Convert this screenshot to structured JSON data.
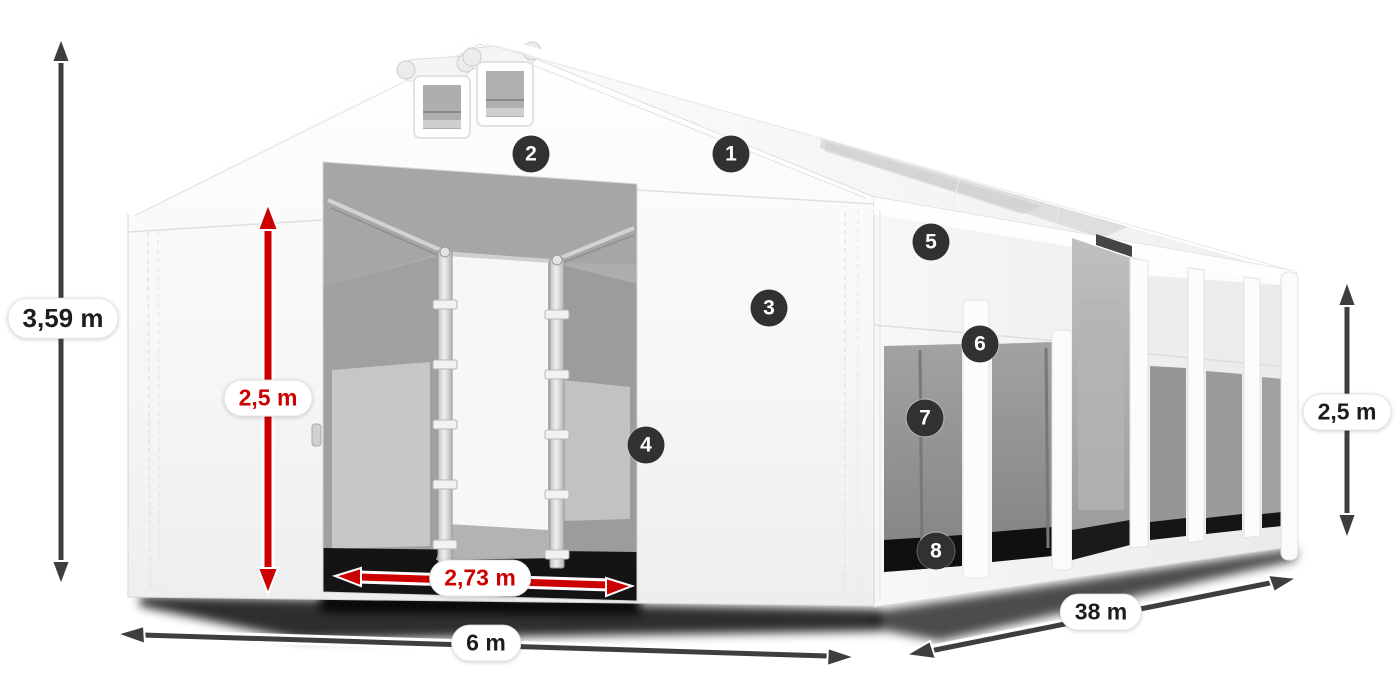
{
  "diagram": {
    "subject": "white storage tent 6 x 38 m, three-quarter view with open front doors and side windows"
  },
  "dimension_labels": {
    "total_height": "3,59 m",
    "inner_door_height": "2,5 m",
    "door_width": "2,73 m",
    "width": "6 m",
    "length": "38 m",
    "side_wall_height": "2,5 m"
  },
  "markers": [
    {
      "number": "1"
    },
    {
      "number": "2"
    },
    {
      "number": "3"
    },
    {
      "number": "4"
    },
    {
      "number": "5"
    },
    {
      "number": "6"
    },
    {
      "number": "7"
    },
    {
      "number": "8"
    }
  ],
  "colors": {
    "background": "#ffffff",
    "dimension_primary": "#3e3e3e",
    "dimension_accent_red": "#cc0000",
    "marker_background": "#313131",
    "marker_text": "#ffffff",
    "fabric_white": "#f7f7f7",
    "interior_gray": "#a6a6a6"
  }
}
